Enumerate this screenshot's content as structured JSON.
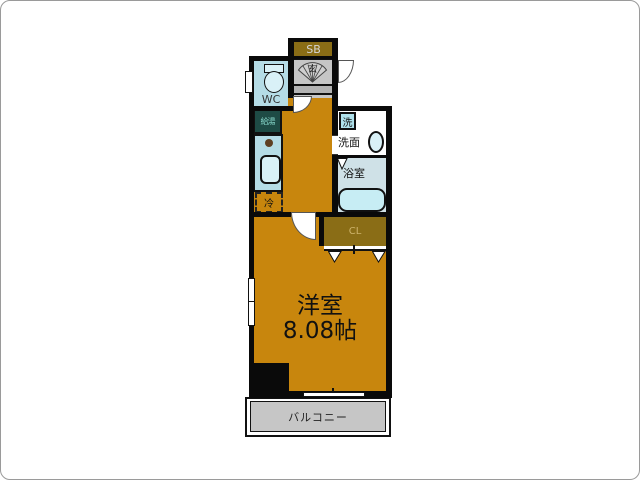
{
  "floorplan": {
    "labels": {
      "shoe_box": "SB",
      "entrance": "玄",
      "toilet": "WC",
      "water_heater": "給湯",
      "refrigerator": "冷",
      "washer": "洗",
      "washroom": "洗面",
      "bathroom": "浴室",
      "closet": "CL",
      "room_type": "洋室",
      "room_area": "8.08帖",
      "balcony": "バルコニー"
    },
    "colors": {
      "floor": "#c8860d",
      "storage": "#8a6d16",
      "water_blue": "#b5dce6",
      "fixture_blue": "#d9f1f7",
      "bath_floor": "#cfe1e7",
      "bathtub": "#c7edf4",
      "entrance_gray": "#c6c6c6",
      "balcony_gray": "#c6c6c6",
      "water_heater": "#1e4b45",
      "wall": "#0a0a0a"
    }
  }
}
